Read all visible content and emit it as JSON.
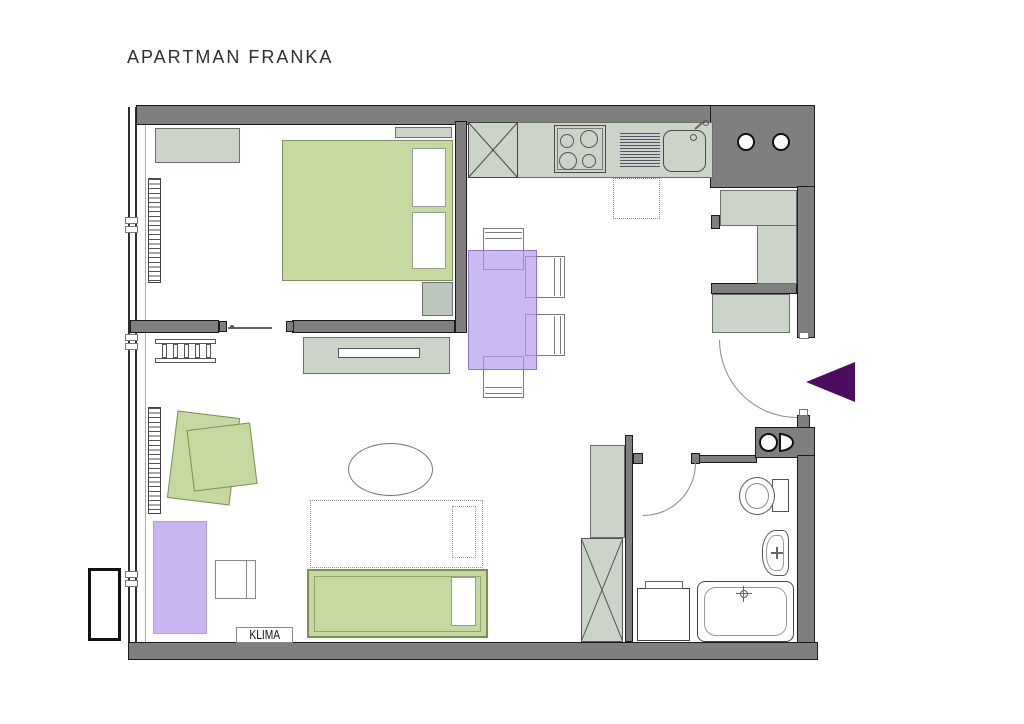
{
  "title": "APARTMAN FRANKA",
  "labels": {
    "klima": "KLIMA"
  },
  "colors": {
    "wall": "#7f7f7f",
    "wall_outline": "#1b1b1b",
    "cabinet": "#ccd3c9",
    "cabinet_border": "#6d6d6d",
    "green": "#c6d9a0",
    "green_border": "#7d8e5c",
    "lavender": "#c9b6f1",
    "arrow": "#4b0c62"
  }
}
